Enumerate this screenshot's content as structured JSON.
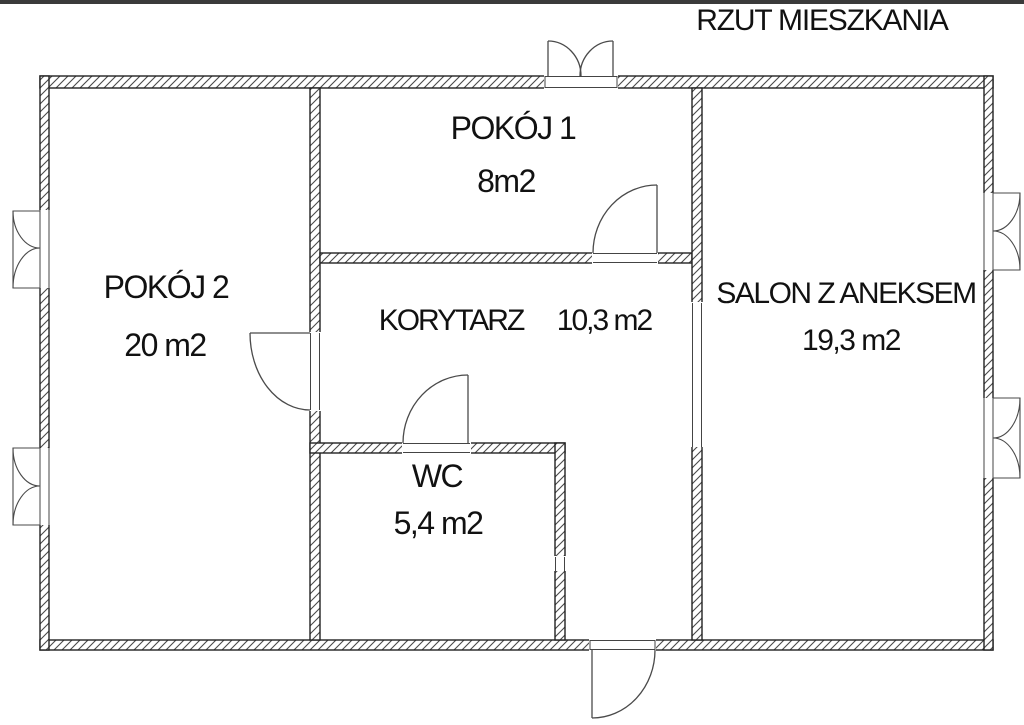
{
  "title": "RZUT MIESZKANIA",
  "rooms": [
    {
      "id": "pokoj1",
      "name": "POKÓJ 1",
      "area": "8m2"
    },
    {
      "id": "pokoj2",
      "name": "POKÓJ 2",
      "area": "20 m2"
    },
    {
      "id": "korytarz",
      "name": "KORYTARZ",
      "area": "10,3 m2"
    },
    {
      "id": "wc",
      "name": "WC",
      "area": "5,4 m2"
    },
    {
      "id": "salon",
      "name": "SALON Z ANEKSEM",
      "area": "19,3 m2"
    }
  ],
  "colors": {
    "background": "#ffffff",
    "wall_outline": "#222222",
    "hatch": "#4a4a4a",
    "symbol_line": "#4a4a4a",
    "text": "#111111",
    "top_bar": "#3a3a3a"
  }
}
